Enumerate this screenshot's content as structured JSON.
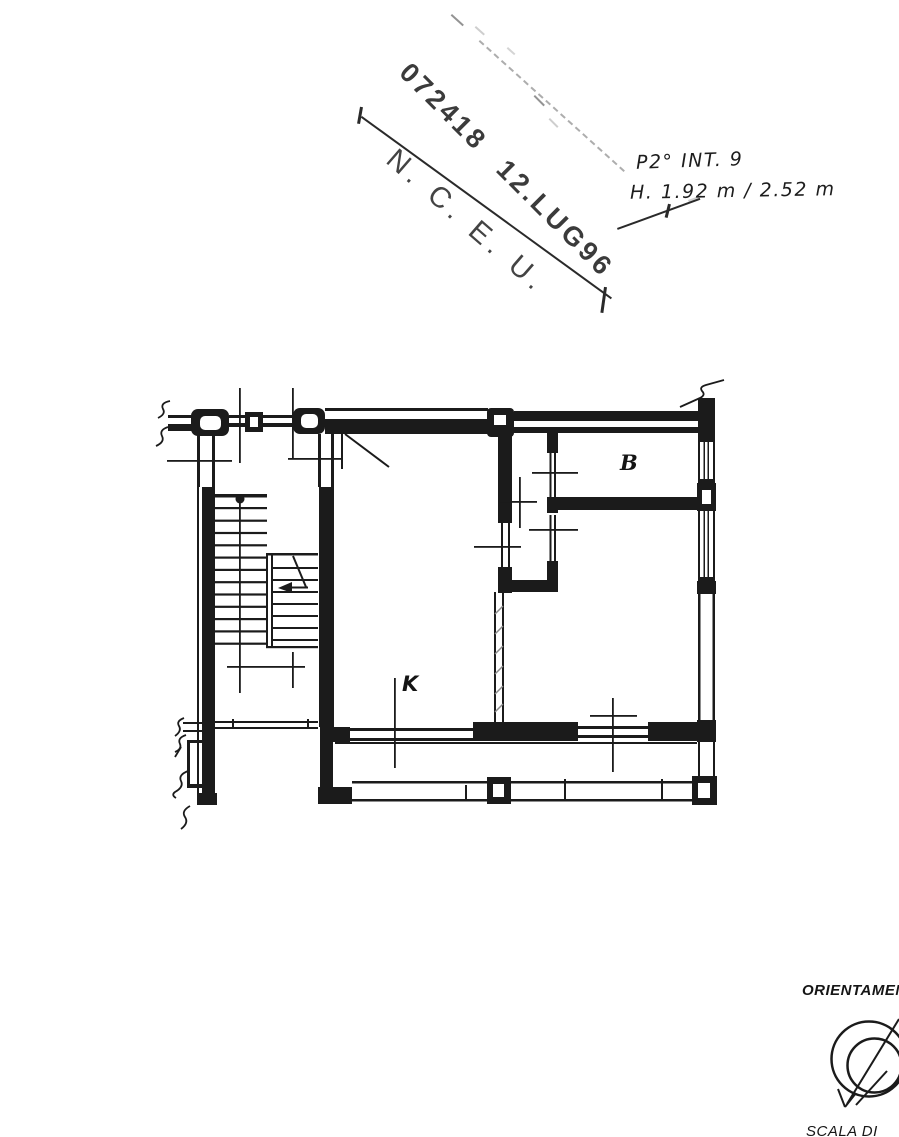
{
  "stamp": {
    "registration_line": "072418  12.LUG96",
    "office_line": "N. C. E. U."
  },
  "annotations": {
    "floor_unit": "P2°  INT. 9",
    "heights": "H.  1.92 m / 2.52 m"
  },
  "room_labels": {
    "bathroom": "B",
    "kitchen": "K"
  },
  "footer": {
    "orientation_label": "ORIENTAMENTO",
    "scale_label": "SCALA DI"
  },
  "colors": {
    "ink": "#1b1b1b",
    "paper": "#ffffff"
  }
}
